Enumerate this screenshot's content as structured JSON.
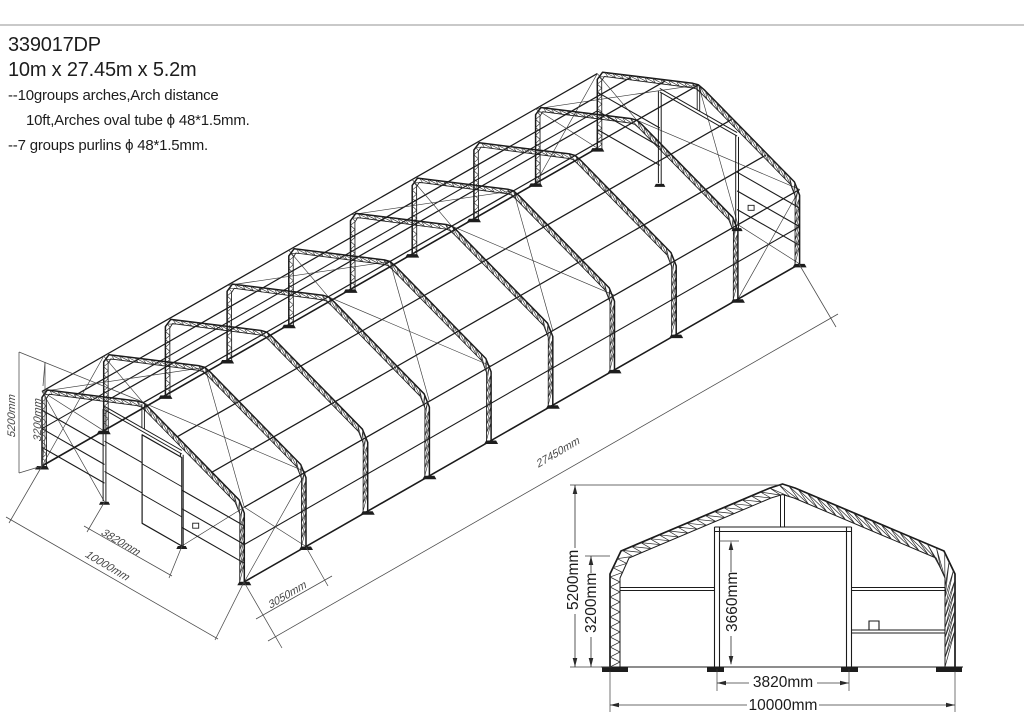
{
  "header": {
    "drawing_number": "339017DP",
    "size": "10m x 27.45m x 5.2m",
    "note1": "--10groups arches,Arch distance",
    "note2": "10ft,Arches oval tube  ϕ 48*1.5mm.",
    "note3": "--7 groups purlins  ϕ 48*1.5mm."
  },
  "iso": {
    "height_total": "5200mm",
    "side_height": "3200mm",
    "door_width": "3820mm",
    "total_width": "10000mm",
    "arch_spacing": "3050mm",
    "total_length": "27450mm"
  },
  "front": {
    "height_total": "5200mm",
    "side_height": "3200mm",
    "door_height": "3660mm",
    "door_width": "3820mm",
    "total_width": "10000mm"
  },
  "colors": {
    "line": "#1b1b1b",
    "dim_line": "#4a4a4a",
    "top_border": "#c9c9c9",
    "background": "#ffffff"
  }
}
